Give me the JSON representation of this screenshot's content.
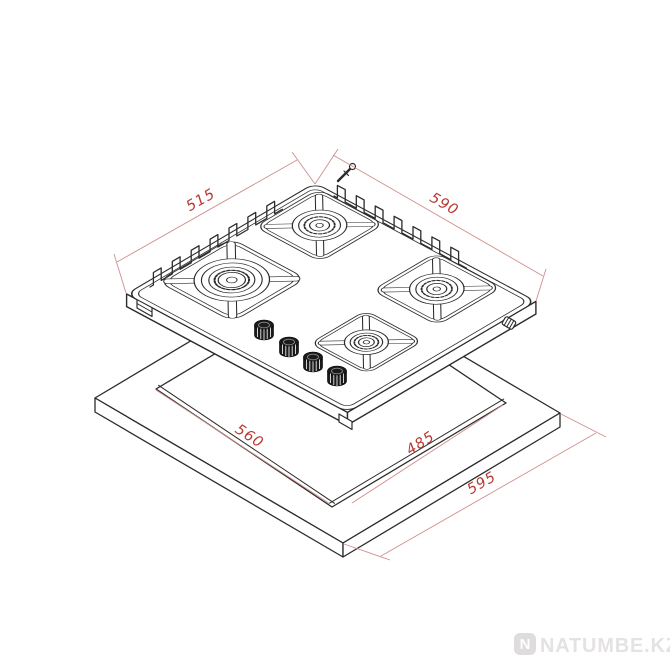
{
  "page": {
    "background": "#ffffff"
  },
  "diagram": {
    "type": "isometric-technical-drawing",
    "subject": "Built-in 4-burner gas hob shown above worktop with installation cutout dimensions (mm)",
    "dimensions": {
      "hob_depth": "515",
      "hob_width": "590",
      "cutout_width": "560",
      "cutout_depth": "485",
      "worktop_depth": "595"
    },
    "colors": {
      "line": "#2b2b2b",
      "dimension_line": "#cf8f8c",
      "dimension_accent": "#b83a32"
    }
  },
  "watermark": {
    "logo_letter": "N",
    "text": "NATUMBE.KZ",
    "color": "#e4e2e2",
    "logo_color": "#dedcdc"
  }
}
